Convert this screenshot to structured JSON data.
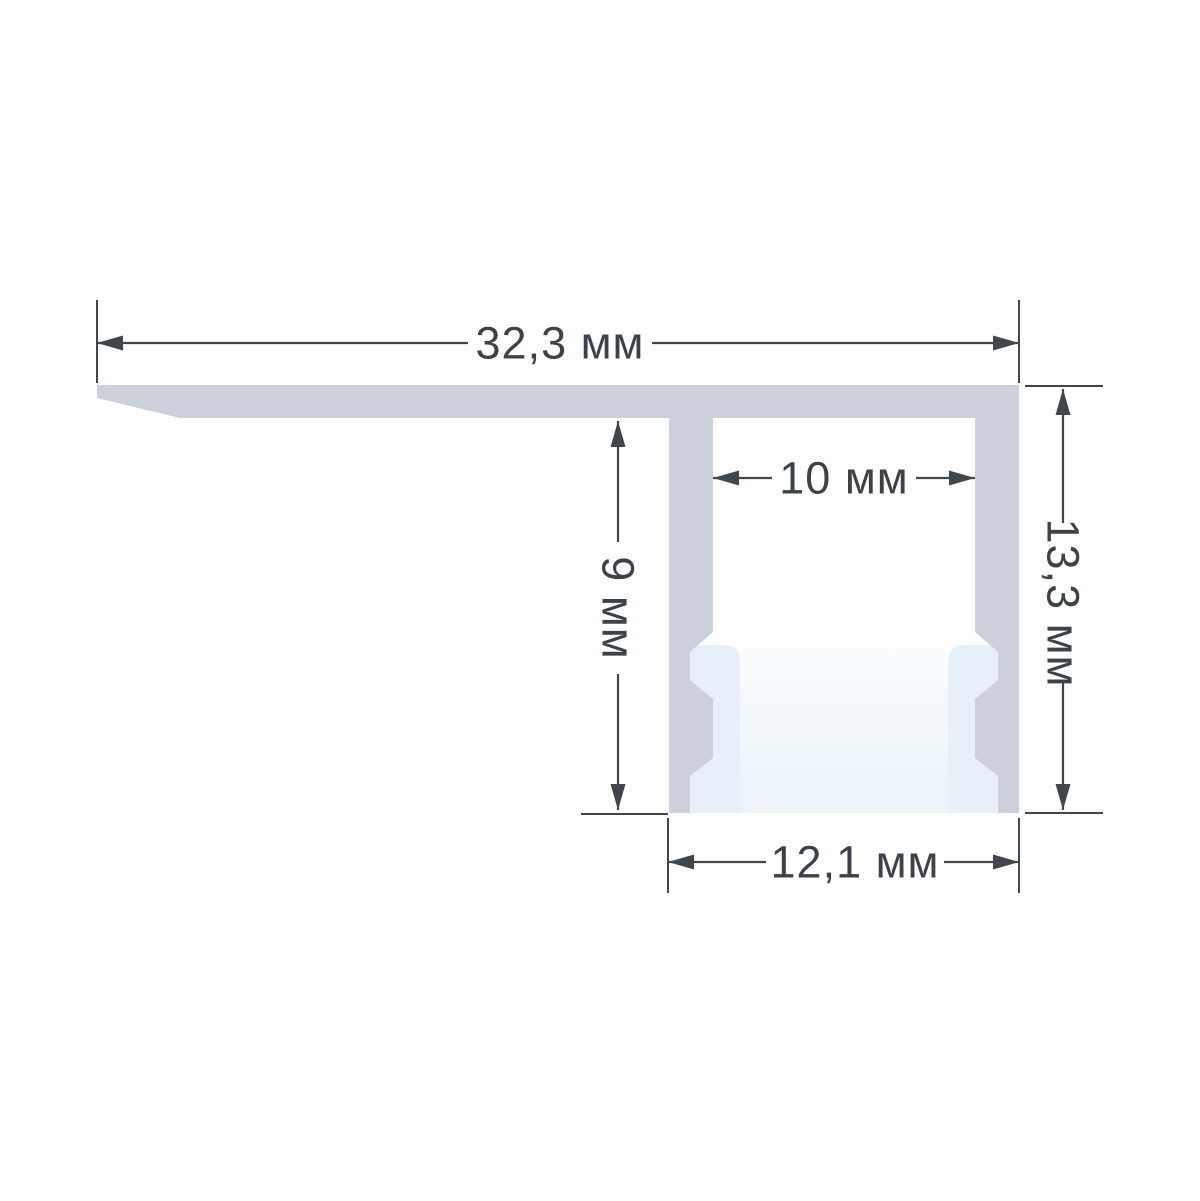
{
  "diagram": {
    "unit": "мм",
    "dimensions": {
      "top_width": {
        "label": "32,3 мм",
        "value": "32,3",
        "orientation": "horizontal"
      },
      "inner_width": {
        "label": "10 мм",
        "value": "10",
        "orientation": "horizontal"
      },
      "web_height": {
        "label": "9 мм",
        "value": "9",
        "orientation": "vertical"
      },
      "right_height": {
        "label": "13,3 мм",
        "value": "13,3",
        "orientation": "vertical"
      },
      "bottom_width": {
        "label": "12,1 мм",
        "value": "12,1",
        "orientation": "horizontal"
      }
    },
    "colors": {
      "profile_body": "#cbd0da",
      "diffuser": "#e7f0f8",
      "diffuser_base": "#ecf4fa",
      "diffuser_glow_top": "#fbfdfe",
      "diffuser_glow_bottom": "#eef5fa",
      "annotation": "#41464d",
      "text": "#3d4248",
      "background": "#ffffff"
    }
  }
}
